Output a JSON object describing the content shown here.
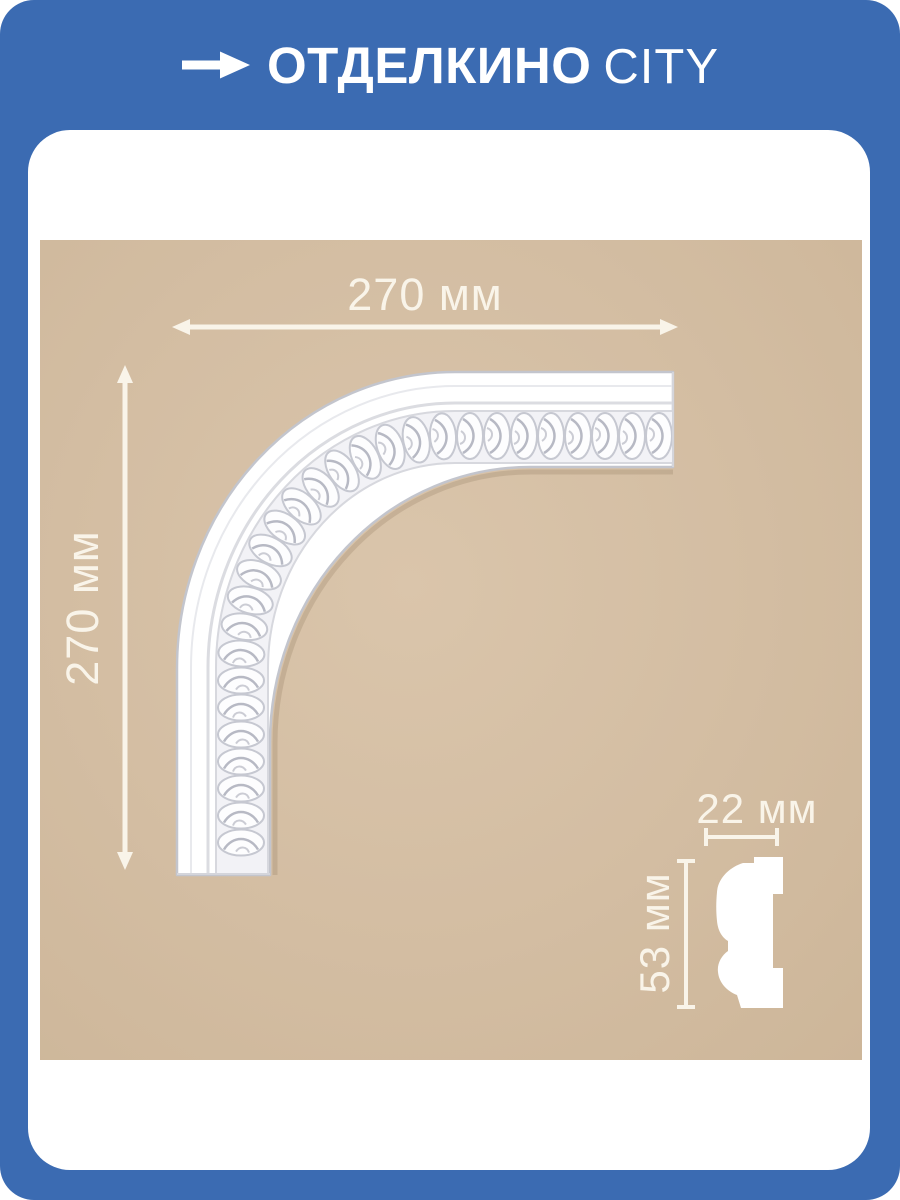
{
  "header": {
    "brand_primary": "ОТДЕЛКИНО",
    "brand_secondary": "CITY",
    "arrow_icon": "arrow-right"
  },
  "drawing": {
    "title": "corner-molding-technical-drawing",
    "width_label": "270 мм",
    "height_label": "270 мм"
  },
  "profile": {
    "width_label": "22 мм",
    "height_label": "53 мм"
  },
  "colors": {
    "frame_blue": "#3b6bb2",
    "photo_beige": "#d3bda2",
    "dim_cream": "#f9f4e9",
    "molding_white": "#ffffff",
    "molding_shade": "#c3c5cd"
  }
}
